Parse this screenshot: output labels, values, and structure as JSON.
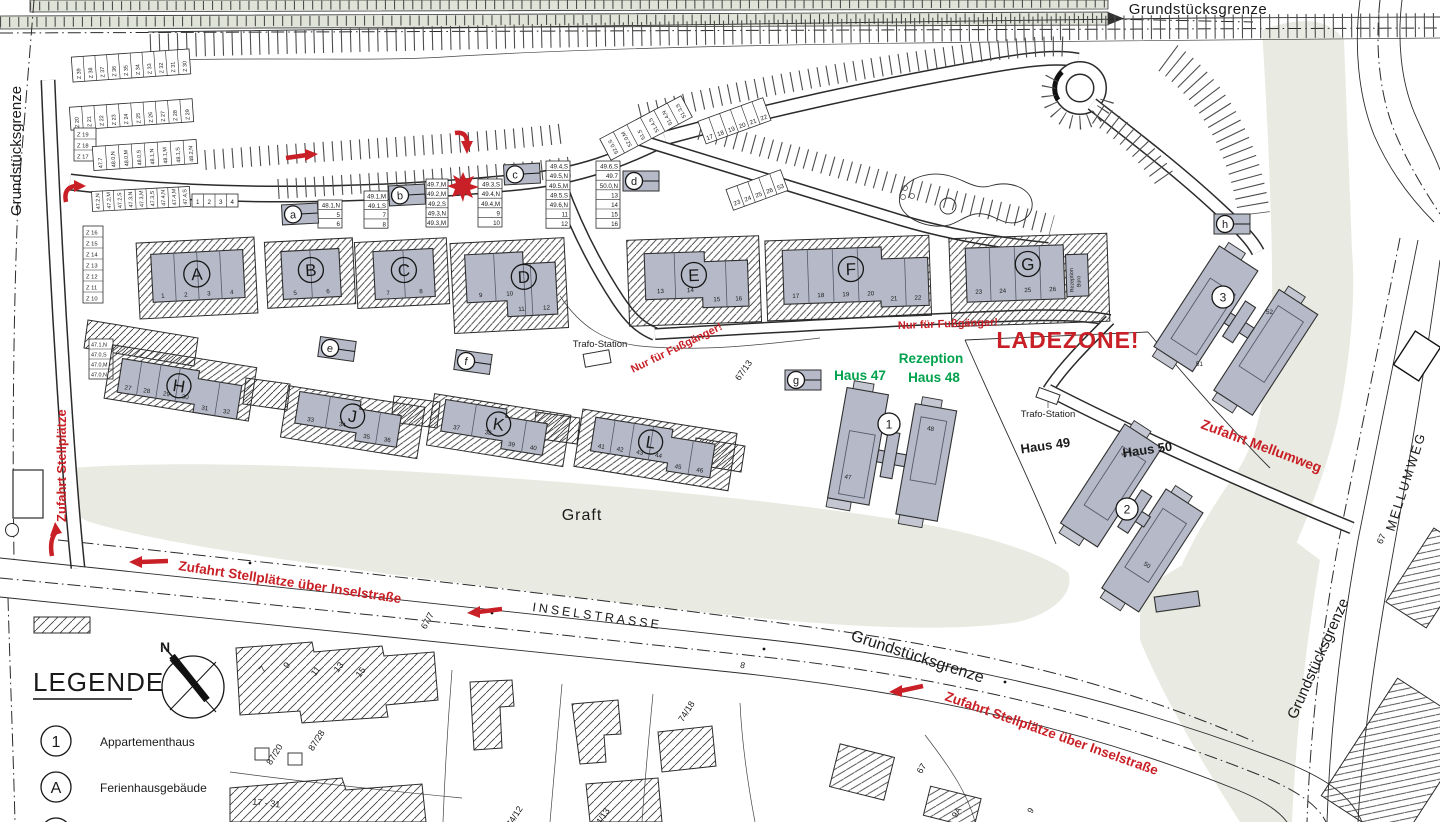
{
  "colors": {
    "red": "#c82026",
    "green": "#00a24d",
    "building_gray": "#b6bac8",
    "area_green": "#e9ebe2"
  },
  "an": {
    "ladezone": "LADEZONE!",
    "fuss1": "Nur für Fußgänger!",
    "fuss2": "Nur für Fußgänger!",
    "zu_stell": "Zufahrt Stellplätze",
    "zu_insel1": "Zufahrt Stellplätze über Inselstraße",
    "zu_insel2": "Zufahrt Stellplätze über Inselstraße",
    "zu_mellum": "Zufahrt Mellumweg",
    "haus47": "Haus 47",
    "rez1": "Rezeption",
    "rez2": "Haus 48",
    "haus49": "Haus 49",
    "haus50": "Haus 50",
    "trafo1": "Trafo-Station",
    "trafo2": "Trafo-Station",
    "rezb1": "Rezeption",
    "rezb2": "Büro",
    "graft": "Graft",
    "insel": "INSELSTRASSE",
    "mellum": "MELLUMWEG",
    "grenze_top": "Grundstücksgrenze",
    "grenze_left": "Grundstücksgrenze",
    "grenze_bottom": "Grundstücksgrenze",
    "grenze_right": "Grundstücksgrenze"
  },
  "lg": {
    "title": "LEGENDE",
    "north": "N",
    "items": [
      {
        "sym": "1",
        "label": "Appartementhaus"
      },
      {
        "sym": "A",
        "label": "Ferienhausgebäude"
      }
    ]
  },
  "fb": [
    {
      "letter": "A",
      "units": [
        "1",
        "2",
        "3",
        "4"
      ]
    },
    {
      "letter": "B",
      "units": [
        "5",
        "6"
      ]
    },
    {
      "letter": "C",
      "units": [
        "7",
        "8"
      ]
    },
    {
      "letter": "D",
      "units": [
        "9",
        "10",
        "11",
        "12"
      ]
    },
    {
      "letter": "E",
      "units": [
        "13",
        "14",
        "15",
        "16"
      ]
    },
    {
      "letter": "F",
      "units": [
        "17",
        "18",
        "19",
        "20",
        "21",
        "22"
      ]
    },
    {
      "letter": "G",
      "units": [
        "23",
        "24",
        "25",
        "26"
      ]
    },
    {
      "letter": "H",
      "units": [
        "27",
        "28",
        "29",
        "30",
        "31",
        "32"
      ]
    },
    {
      "letter": "J",
      "units": [
        "33",
        "34",
        "35",
        "36"
      ]
    },
    {
      "letter": "K",
      "units": [
        "37",
        "38",
        "39",
        "40"
      ]
    },
    {
      "letter": "L",
      "units": [
        "41",
        "42",
        "43",
        "44",
        "45",
        "46"
      ]
    }
  ],
  "ab": [
    {
      "num": "1",
      "houses": [
        "47",
        "48"
      ]
    },
    {
      "num": "2",
      "houses": [
        "49",
        "50"
      ]
    },
    {
      "num": "3",
      "houses": [
        "51",
        "52"
      ]
    }
  ],
  "mk": [
    "a",
    "b",
    "c",
    "d",
    "e",
    "f",
    "g",
    "h"
  ],
  "pk": {
    "z_top": [
      "Z 39",
      "Z 38",
      "Z 37",
      "Z 36",
      "Z 35",
      "Z 34",
      "Z 33",
      "Z 32",
      "Z 31",
      "Z 30"
    ],
    "z_mid": [
      "Z 20",
      "Z 21",
      "Z 22",
      "Z 23",
      "Z 24",
      "Z 25",
      "Z 26",
      "Z 27",
      "Z 28",
      "Z 29"
    ],
    "z_colA": [
      "Z 19",
      "Z 18",
      "Z 17"
    ],
    "z_colB": [
      "Z 16",
      "Z 15",
      "Z 14",
      "Z 13",
      "Z 12",
      "Z 11",
      "Z 10"
    ],
    "row47": [
      "47.7",
      "48.0,N",
      "48.0,M",
      "48.0,S",
      "48.1,N",
      "48.1,M",
      "48.1,S",
      "48.2,N"
    ],
    "row472": [
      "47.2,N",
      "47.2,M",
      "47.2,S",
      "47.3,N",
      "47.3,M",
      "47.3,S",
      "47.4,N",
      "47.4,M",
      "47.4,S"
    ],
    "row472_nums": [
      "1",
      "2",
      "3",
      "4"
    ],
    "col470": [
      "47.1,N",
      "47.0,S",
      "47.0,M",
      "47.0,N"
    ],
    "tbl_a": [
      "48.1,N",
      "5",
      "6"
    ],
    "tbl_b": [
      "49.1,M",
      "49.1,S",
      "7",
      "8"
    ],
    "tbl_star": [
      "49.7,M",
      "49.2,M",
      "49.2,S",
      "49.3,N",
      "49.3,M"
    ],
    "tbl_c": [
      "49.3,S",
      "49.4,N",
      "49.4,M",
      "9",
      "10"
    ],
    "tbl_mid": [
      "49.4,S",
      "49.5,N",
      "49.5,M",
      "49.5,S",
      "49.6,N",
      "11",
      "12"
    ],
    "tbl_d": [
      "49.6,S",
      "49.7",
      "50.0,N",
      "13",
      "14",
      "15",
      "16"
    ],
    "stalls_1722": [
      "17",
      "18",
      "19",
      "20",
      "21",
      "22"
    ],
    "stalls_2353": [
      "23",
      "24",
      "25",
      "26",
      "53"
    ],
    "col51": [
      "52.0,S",
      "52.0,M",
      "51.5",
      "51.4,S",
      "51.4,N",
      "51.3,S"
    ]
  },
  "pc": {
    "p67_7": "67/7",
    "p67_13": "67/13",
    "p67a": "67",
    "p67b": "67",
    "p87_20": "87/20",
    "p87_28": "87/28",
    "p74_12": "74/12",
    "p74_13": "74/13",
    "p74_18": "74/18",
    "p17_31": "17 - 31",
    "p9a": "9A",
    "p9": "9",
    "p8": "8",
    "hn": [
      "7",
      "9",
      "11",
      "13",
      "15"
    ]
  }
}
